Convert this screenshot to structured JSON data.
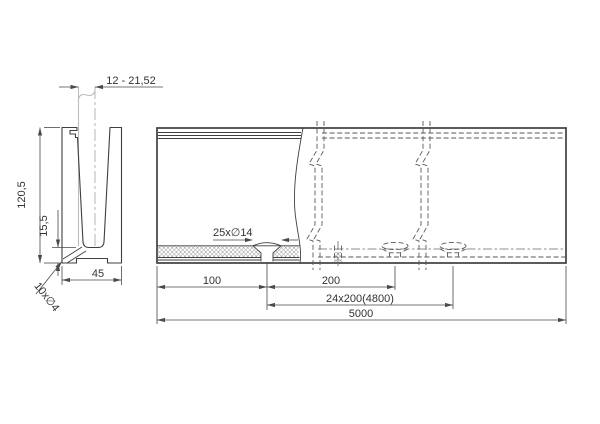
{
  "dims": {
    "glass_range": "12 - 21,52",
    "profile_height": "120,5",
    "base_height": "15,5",
    "base_width": "45",
    "drain_holes": "10x∅4",
    "anchor_holes": "25x∅14",
    "end_offset": "100",
    "hole_pitch": "200",
    "pitch_total": "24x200(4800)",
    "total_length": "5000"
  },
  "colors": {
    "object_line": "#3f3f3f",
    "dimension_line": "#4a4a4a",
    "glass_line": "#bcbcbc",
    "background": "#ffffff"
  }
}
